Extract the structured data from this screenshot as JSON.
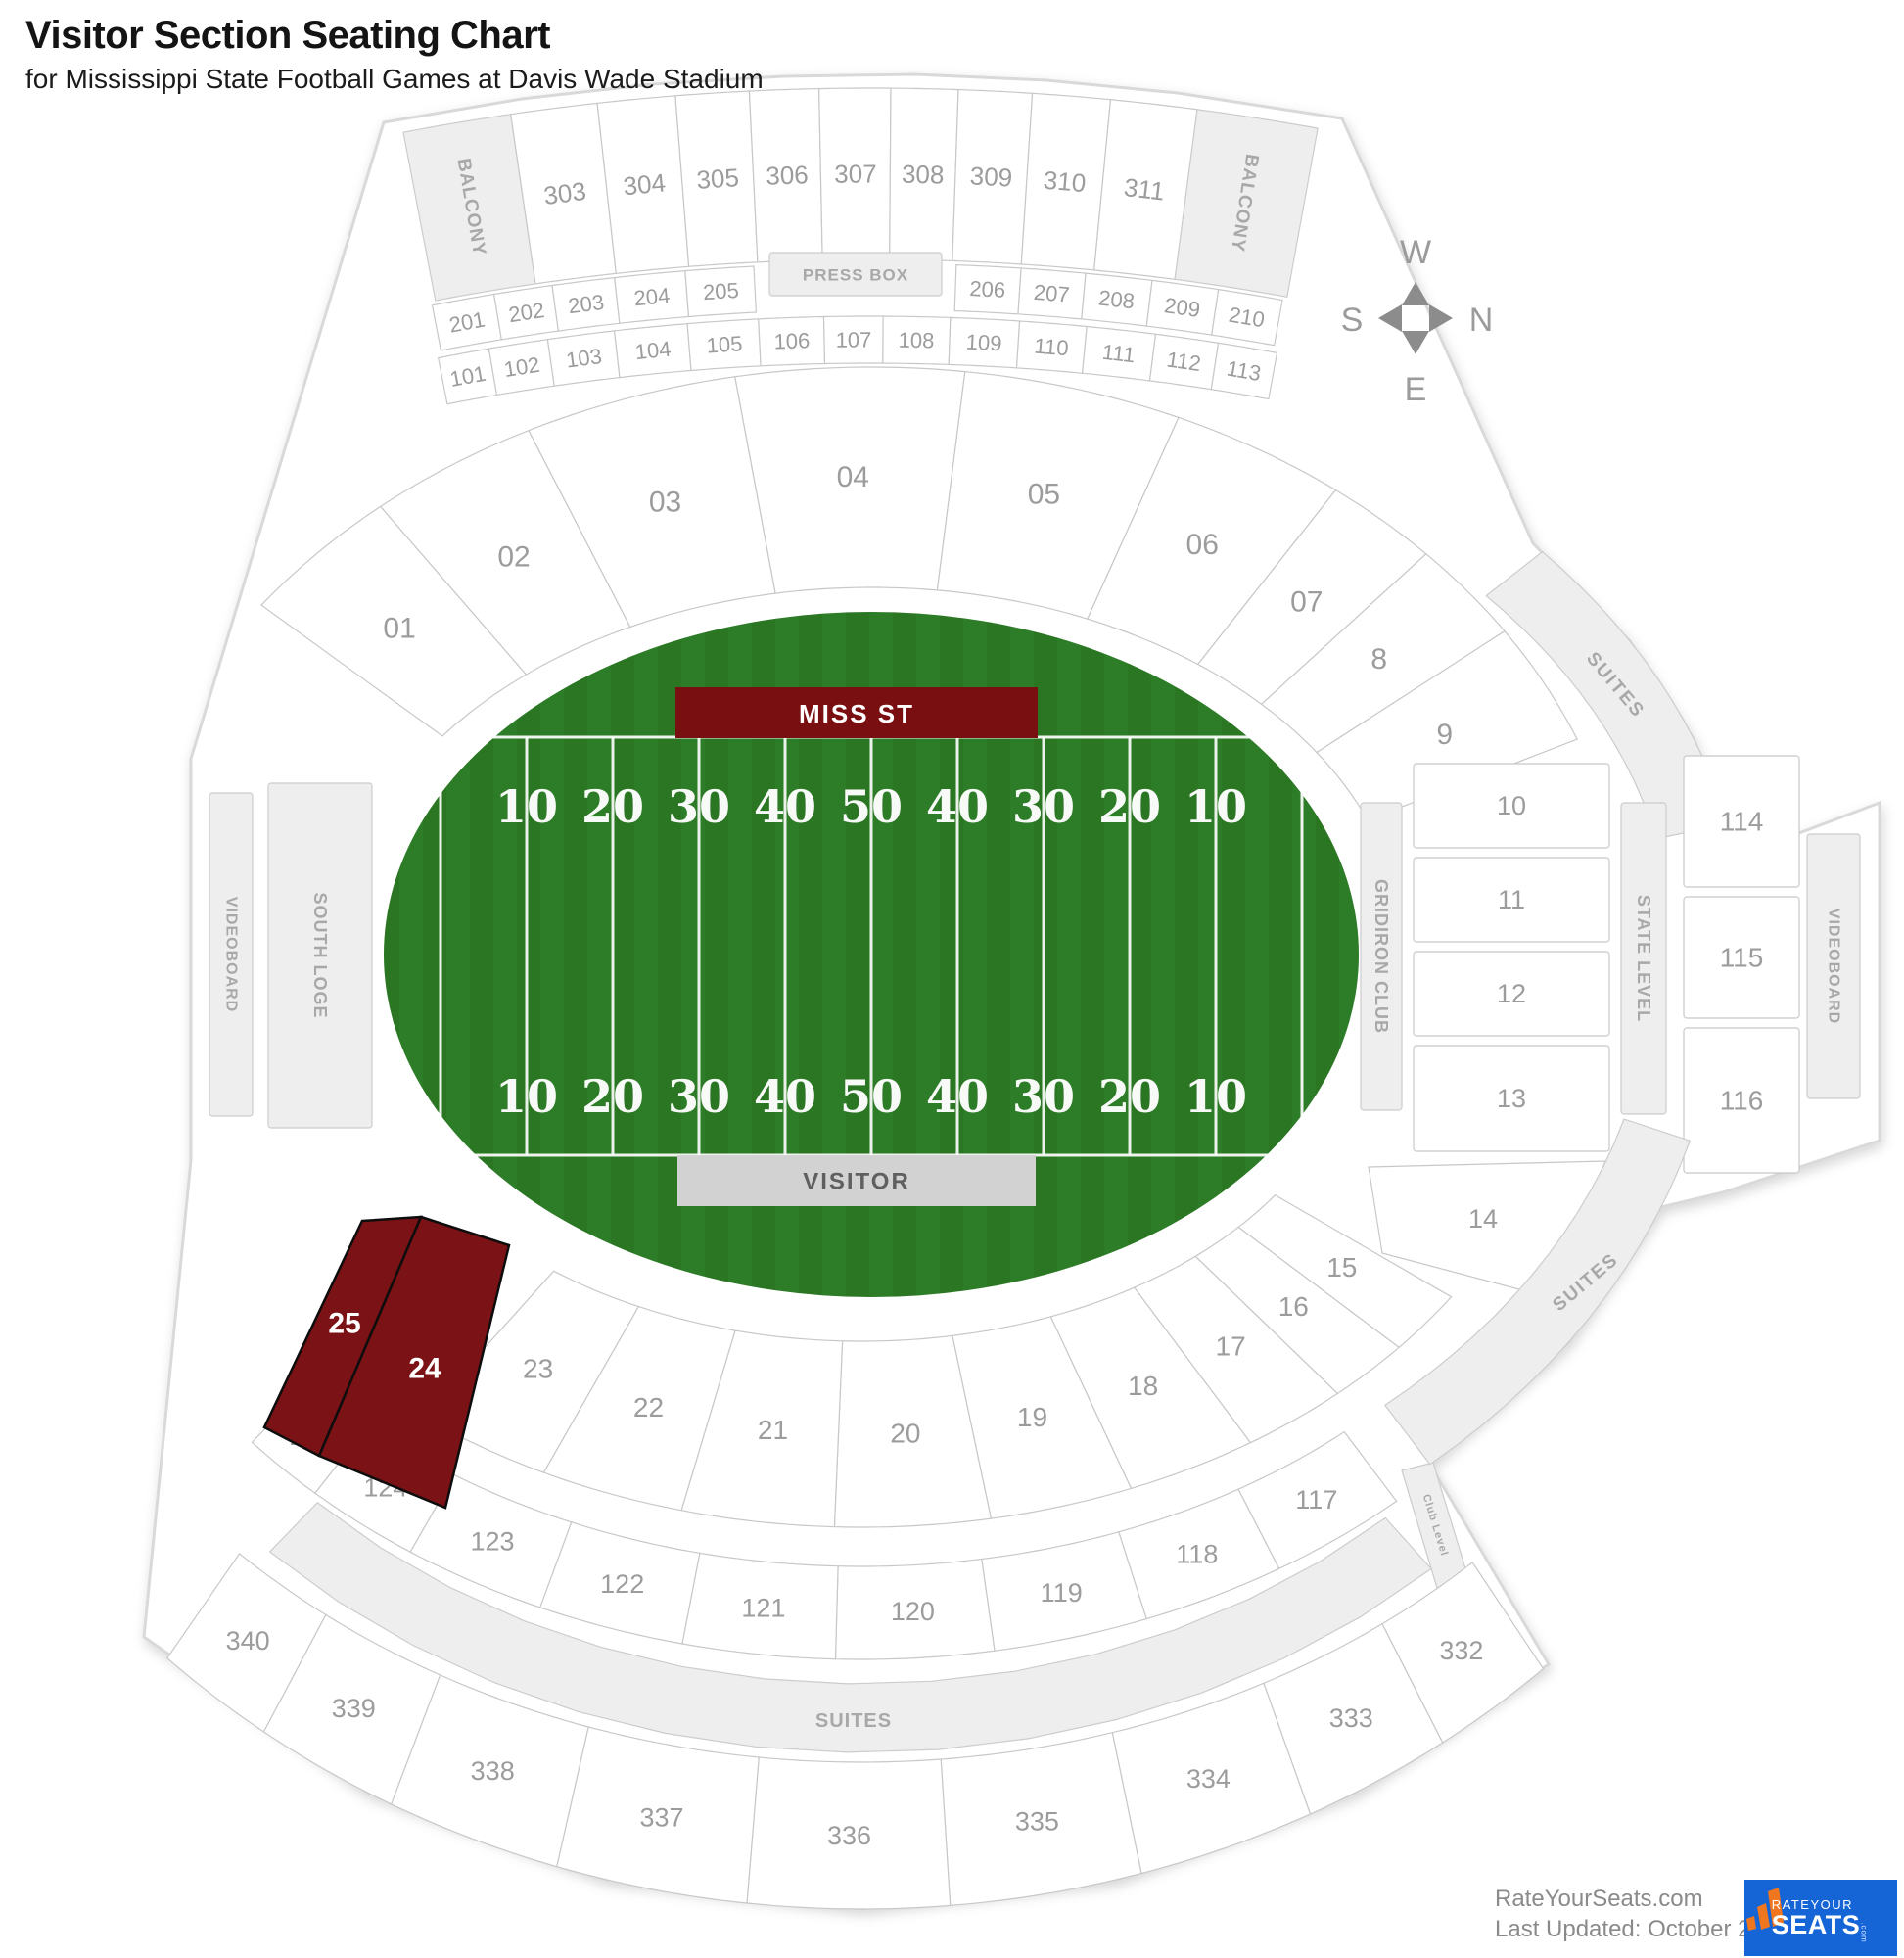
{
  "header": {
    "title": "Visitor Section Seating Chart",
    "subtitle": "for Mississippi State Football Games at Davis Wade Stadium"
  },
  "compass": {
    "top": "W",
    "left": "S",
    "right": "N",
    "bottom": "E"
  },
  "field": {
    "home_banner": "MISS ST",
    "visitor_banner": "VISITOR",
    "yard_numbers": [
      "10",
      "20",
      "30",
      "40",
      "50",
      "40",
      "30",
      "20",
      "10"
    ]
  },
  "sections": [
    {
      "id": "balcony-left",
      "label": "BALCONY",
      "type": "zone"
    },
    {
      "id": "s303",
      "label": "303",
      "type": "seat"
    },
    {
      "id": "s304",
      "label": "304",
      "type": "seat"
    },
    {
      "id": "s305",
      "label": "305",
      "type": "seat"
    },
    {
      "id": "s306",
      "label": "306",
      "type": "seat"
    },
    {
      "id": "s307",
      "label": "307",
      "type": "seat"
    },
    {
      "id": "s308",
      "label": "308",
      "type": "seat"
    },
    {
      "id": "s309",
      "label": "309",
      "type": "seat"
    },
    {
      "id": "s310",
      "label": "310",
      "type": "seat"
    },
    {
      "id": "s311",
      "label": "311",
      "type": "seat"
    },
    {
      "id": "balcony-right",
      "label": "BALCONY",
      "type": "zone"
    },
    {
      "id": "press-box",
      "label": "PRESS BOX",
      "type": "zone"
    },
    {
      "id": "s201",
      "label": "201",
      "type": "seat"
    },
    {
      "id": "s202",
      "label": "202",
      "type": "seat"
    },
    {
      "id": "s203",
      "label": "203",
      "type": "seat"
    },
    {
      "id": "s204",
      "label": "204",
      "type": "seat"
    },
    {
      "id": "s205",
      "label": "205",
      "type": "seat"
    },
    {
      "id": "s206",
      "label": "206",
      "type": "seat"
    },
    {
      "id": "s207",
      "label": "207",
      "type": "seat"
    },
    {
      "id": "s208",
      "label": "208",
      "type": "seat"
    },
    {
      "id": "s209",
      "label": "209",
      "type": "seat"
    },
    {
      "id": "s210",
      "label": "210",
      "type": "seat"
    },
    {
      "id": "s101",
      "label": "101",
      "type": "seat"
    },
    {
      "id": "s102",
      "label": "102",
      "type": "seat"
    },
    {
      "id": "s103",
      "label": "103",
      "type": "seat"
    },
    {
      "id": "s104",
      "label": "104",
      "type": "seat"
    },
    {
      "id": "s105",
      "label": "105",
      "type": "seat"
    },
    {
      "id": "s106",
      "label": "106",
      "type": "seat"
    },
    {
      "id": "s107",
      "label": "107",
      "type": "seat"
    },
    {
      "id": "s108",
      "label": "108",
      "type": "seat"
    },
    {
      "id": "s109",
      "label": "109",
      "type": "seat"
    },
    {
      "id": "s110",
      "label": "110",
      "type": "seat"
    },
    {
      "id": "s111",
      "label": "111",
      "type": "seat"
    },
    {
      "id": "s112",
      "label": "112",
      "type": "seat"
    },
    {
      "id": "s113",
      "label": "113",
      "type": "seat"
    },
    {
      "id": "s01",
      "label": "01",
      "type": "seat"
    },
    {
      "id": "s02",
      "label": "02",
      "type": "seat"
    },
    {
      "id": "s03",
      "label": "03",
      "type": "seat"
    },
    {
      "id": "s04",
      "label": "04",
      "type": "seat"
    },
    {
      "id": "s05",
      "label": "05",
      "type": "seat"
    },
    {
      "id": "s06",
      "label": "06",
      "type": "seat"
    },
    {
      "id": "s07",
      "label": "07",
      "type": "seat"
    },
    {
      "id": "s08",
      "label": "8",
      "type": "seat"
    },
    {
      "id": "s09",
      "label": "9",
      "type": "seat"
    },
    {
      "id": "suites-upper-right",
      "label": "SUITES",
      "type": "zone"
    },
    {
      "id": "gridiron-club",
      "label": "GRIDIRON CLUB",
      "type": "zone"
    },
    {
      "id": "g10",
      "label": "10",
      "type": "seat"
    },
    {
      "id": "g11",
      "label": "11",
      "type": "seat"
    },
    {
      "id": "g12",
      "label": "12",
      "type": "seat"
    },
    {
      "id": "g13",
      "label": "13",
      "type": "seat"
    },
    {
      "id": "g14",
      "label": "14",
      "type": "seat"
    },
    {
      "id": "state-level",
      "label": "STATE LEVEL",
      "type": "zone"
    },
    {
      "id": "s114",
      "label": "114",
      "type": "seat"
    },
    {
      "id": "s115",
      "label": "115",
      "type": "seat"
    },
    {
      "id": "s116",
      "label": "116",
      "type": "seat"
    },
    {
      "id": "videoboard-right",
      "label": "VIDEOBOARD",
      "type": "zone"
    },
    {
      "id": "videoboard-left",
      "label": "VIDEOBOARD",
      "type": "zone"
    },
    {
      "id": "south-loge",
      "label": "SOUTH LOGE",
      "type": "zone"
    },
    {
      "id": "s15",
      "label": "15",
      "type": "seat"
    },
    {
      "id": "s16",
      "label": "16",
      "type": "seat"
    },
    {
      "id": "s17",
      "label": "17",
      "type": "seat"
    },
    {
      "id": "s18",
      "label": "18",
      "type": "seat"
    },
    {
      "id": "s19",
      "label": "19",
      "type": "seat"
    },
    {
      "id": "s20",
      "label": "20",
      "type": "seat"
    },
    {
      "id": "s21",
      "label": "21",
      "type": "seat"
    },
    {
      "id": "s22",
      "label": "22",
      "type": "seat"
    },
    {
      "id": "s23",
      "label": "23",
      "type": "seat"
    },
    {
      "id": "s117",
      "label": "117",
      "type": "seat"
    },
    {
      "id": "s118",
      "label": "118",
      "type": "seat"
    },
    {
      "id": "s119",
      "label": "119",
      "type": "seat"
    },
    {
      "id": "s120",
      "label": "120",
      "type": "seat"
    },
    {
      "id": "s121",
      "label": "121",
      "type": "seat"
    },
    {
      "id": "s122",
      "label": "122",
      "type": "seat"
    },
    {
      "id": "s123",
      "label": "123",
      "type": "seat"
    },
    {
      "id": "s124",
      "label": "124",
      "type": "seat"
    },
    {
      "id": "s125",
      "label": "125",
      "type": "seat"
    },
    {
      "id": "club-level",
      "label": "Club Level",
      "type": "zone"
    },
    {
      "id": "suites-lower-right",
      "label": "SUITES",
      "type": "zone"
    },
    {
      "id": "suites-bottom",
      "label": "SUITES",
      "type": "zone"
    },
    {
      "id": "b332",
      "label": "332",
      "type": "seat"
    },
    {
      "id": "b333",
      "label": "333",
      "type": "seat"
    },
    {
      "id": "b334",
      "label": "334",
      "type": "seat"
    },
    {
      "id": "b335",
      "label": "335",
      "type": "seat"
    },
    {
      "id": "b336",
      "label": "336",
      "type": "seat"
    },
    {
      "id": "b337",
      "label": "337",
      "type": "seat"
    },
    {
      "id": "b338",
      "label": "338",
      "type": "seat"
    },
    {
      "id": "b339",
      "label": "339",
      "type": "seat"
    },
    {
      "id": "b340",
      "label": "340",
      "type": "seat"
    },
    {
      "id": "s25",
      "label": "25",
      "type": "premium"
    },
    {
      "id": "s24",
      "label": "24",
      "type": "premium"
    }
  ],
  "footer": {
    "site": "RateYourSeats.com",
    "updated": "Last Updated: October 27, 2025",
    "logo_line1": "RATEYOUR",
    "logo_line2": "SEATS",
    "logo_com": ".com"
  },
  "colors": {
    "turf": "#2d7c27",
    "turf_dark": "#2a7623",
    "home_banner": "#7a0f12",
    "visitor_banner": "#d2d2d2",
    "visitor_text": "#5f5f5f",
    "highlight": "#7b1215",
    "highlight_stroke": "#0d0d0d",
    "seat_fill": "#ffffff",
    "seat_stroke": "#c8c8c8",
    "zone_fill": "#eeeeee",
    "zone_stroke": "#cccccc",
    "seat_label": "#9c9c9c",
    "zone_label": "#a8a8a8",
    "compass": "#8c8c8c",
    "logo_blue": "#1565d7",
    "logo_orange": "#f0761f",
    "silhouette_stroke": "#d9d9d9"
  }
}
